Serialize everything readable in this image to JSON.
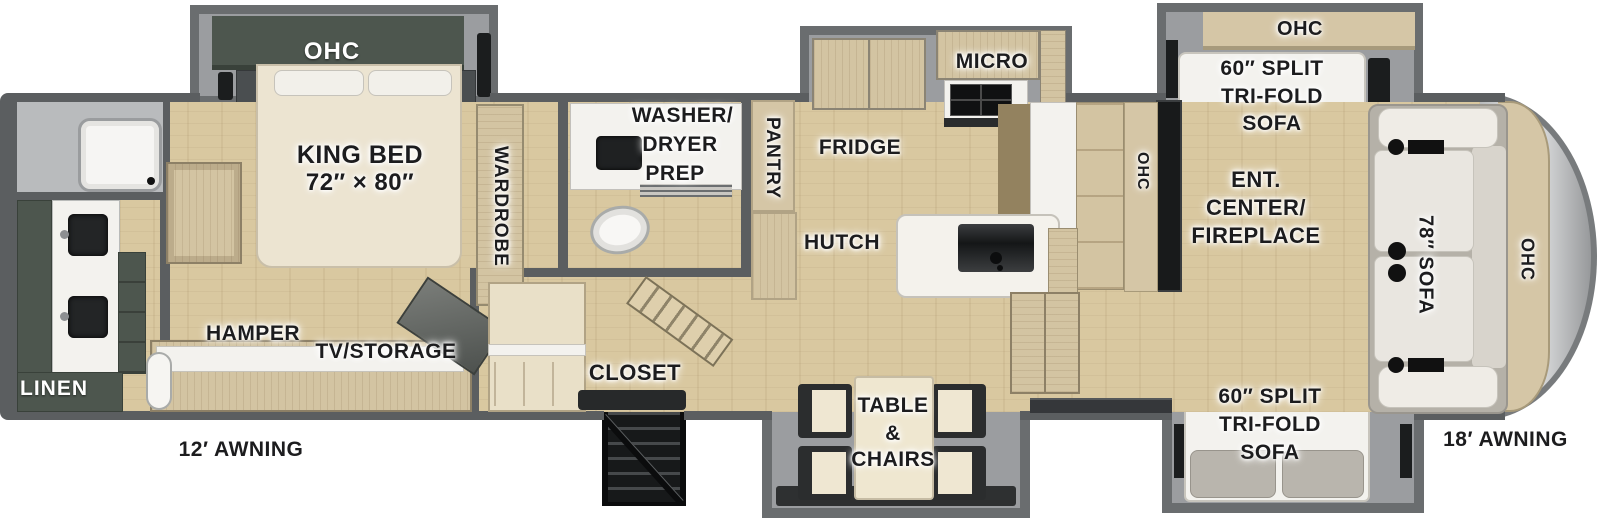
{
  "colors": {
    "wall": "#5b5e60",
    "slide": "#6a6d6f",
    "floor": "#d9c8a0",
    "wood": "#d3c4a2",
    "tan": "#d5c6a6",
    "green": "#4d564e",
    "dark": "#1b1d1e",
    "white": "#f3f2ee",
    "silver": "#e8e9ea",
    "text": "#1c1c1e"
  },
  "labels": {
    "bedroom_ohc": "OHC",
    "king_bed_line1": "KING BED",
    "king_bed_line2": "72″ × 80″",
    "wardrobe": "WARDROBE",
    "linen": "LINEN",
    "hamper": "HAMPER",
    "tv_storage": "TV/STORAGE",
    "washer_line1": "WASHER/",
    "washer_line2": "DRYER",
    "washer_line3": "PREP",
    "pantry": "PANTRY",
    "closet": "CLOSET",
    "fridge": "FRIDGE",
    "micro": "MICRO",
    "hutch": "HUTCH",
    "kitchen_ohc": "OHC",
    "table_line1": "TABLE",
    "table_line2": "&",
    "table_line3": "CHAIRS",
    "front_top_ohc": "OHC",
    "sofa_top_line1": "60″ SPLIT",
    "sofa_top_line2": "TRI-FOLD",
    "sofa_top_line3": "SOFA",
    "ent_line1": "ENT.",
    "ent_line2": "CENTER/",
    "ent_line3": "FIREPLACE",
    "sofa_front": "78″ SOFA",
    "front_cap_ohc": "OHC",
    "sofa_bottom_line1": "60″ SPLIT",
    "sofa_bottom_line2": "TRI-FOLD",
    "sofa_bottom_line3": "SOFA",
    "awning_left": "12′ AWNING",
    "awning_right": "18′ AWNING"
  }
}
